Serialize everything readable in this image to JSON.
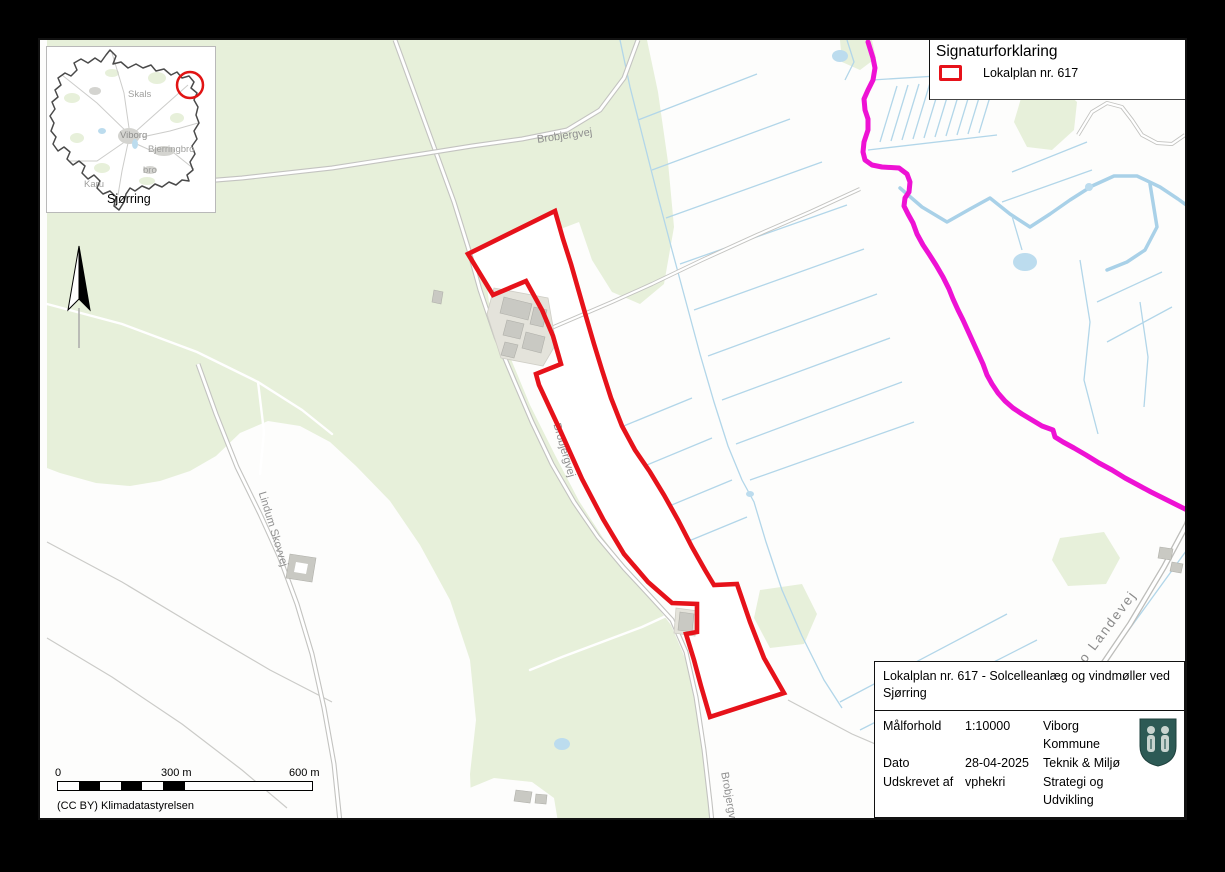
{
  "colors": {
    "plan_red": "#e6121a",
    "boundary_magenta": "#ee12d4",
    "forest_green": "#e7f0da",
    "water_blue": "#b2d6e9",
    "road_gray": "#c3c3c0",
    "label_gray": "#8f8f8f",
    "shield_teal": "#2d5a55"
  },
  "legend": {
    "title": "Signaturforklaring",
    "item_label": "Lokalplan nr. 617"
  },
  "inset": {
    "caption": "Sjørring",
    "towns": [
      "Skals",
      "Viborg",
      "Bjerringbro",
      "bro",
      "Karu"
    ]
  },
  "road_labels": {
    "brobjergvej_top": "Brobjergvej",
    "brobjergvej_mid": "Brobjergvej",
    "brobjergvej_bottom": "Brobjergvej",
    "lindum_skovvej": "Lindum Skovvej",
    "hobro_landevej": "Hobro Landevej"
  },
  "scale_bar": {
    "tick_0": "0",
    "tick_300": "300 m",
    "tick_600": "600 m"
  },
  "attribution": "(CC BY) Klimadatastyrelsen",
  "info_box": {
    "title_line1": "Lokalplan nr. 617 - Solcelleanlæg og vindmøller ved",
    "title_line2": "Sjørring",
    "rows": [
      {
        "label": "Målforhold",
        "value": "1:10000",
        "org": "Viborg Kommune"
      },
      {
        "label": "Dato",
        "value": "28-04-2025",
        "org": "Teknik & Miljø"
      },
      {
        "label": "Udskrevet af",
        "value": "vphekri",
        "org": "Strategi og Udvikling"
      }
    ]
  }
}
